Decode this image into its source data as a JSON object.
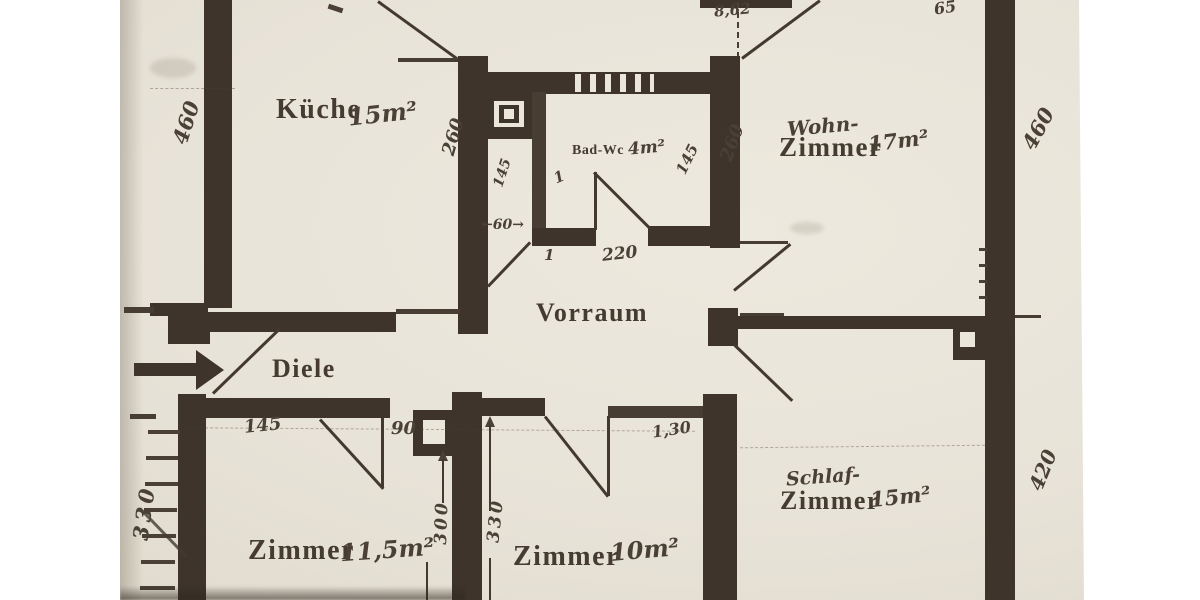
{
  "document_type": "apartment floor plan (scanned photo)",
  "colors": {
    "background": "#ffffff",
    "paper": "#e9e4da",
    "wall": "#3e342c",
    "printed_ink": "#453b30",
    "handwritten_ink": "#4a4036"
  },
  "rooms": {
    "kueche": {
      "name": "Küche",
      "area": "15m²"
    },
    "bad_wc": {
      "name": "Bad-Wc",
      "area": "4m²"
    },
    "wohnzimmer": {
      "name_prefix": "Wohn-",
      "name": "Zimmer",
      "area": "17m²"
    },
    "vorraum": {
      "name": "Vorraum"
    },
    "diele": {
      "name": "Diele"
    },
    "zimmer_1": {
      "name": "Zimmer",
      "area": "11,5m²"
    },
    "zimmer_2": {
      "name": "Zimmer",
      "area": "10m²"
    },
    "schlafzimmer": {
      "name_prefix": "Schlaf-",
      "name": "Zimmer",
      "area": "15m²"
    }
  },
  "dimensions": {
    "left_height": "460",
    "left_bottom_height": "330",
    "kueche_right_depth": "260",
    "shaft_width": "145",
    "shaft_door_width": "←60→",
    "badwc_width": "220",
    "badwc_depth": "145",
    "wohnzimmer_left_depth": "260",
    "right_height_top": "460",
    "right_height_bottom": "420",
    "top_door_note": "8,62",
    "top_right_note": "65",
    "diele_wall_segment": "145",
    "diele_door_width": "90",
    "zimmer2_wall_note": "1,30",
    "zimmer1_depth": "300",
    "zimmer2_depth": "330",
    "mark_one_a": "1",
    "mark_one_b": "1"
  }
}
